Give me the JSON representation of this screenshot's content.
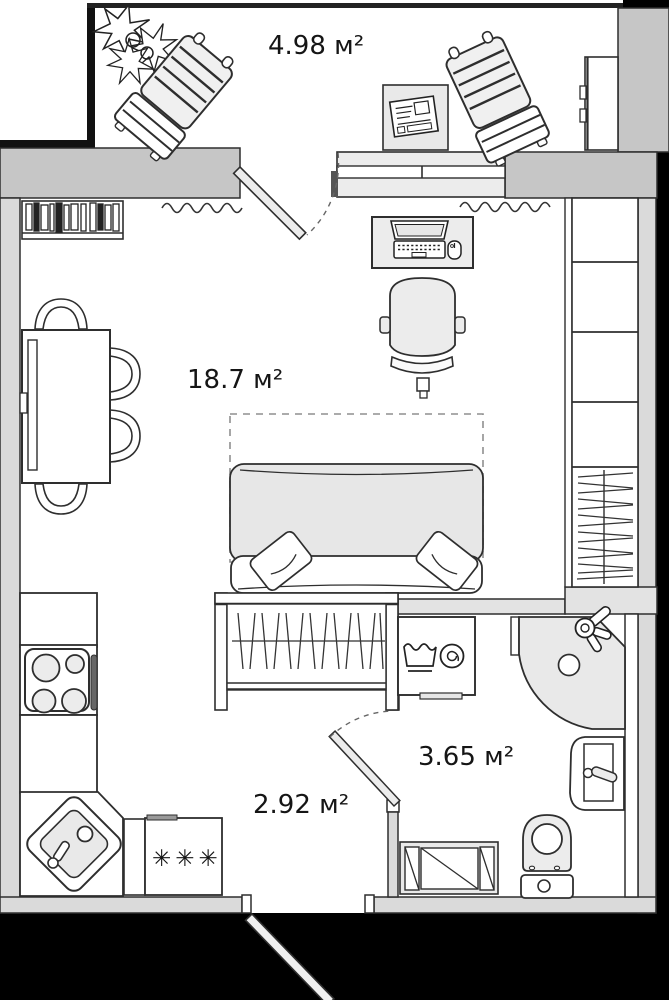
{
  "rooms": {
    "balcony": {
      "area_label": "4.98 м²"
    },
    "living_room": {
      "area_label": "18.7 м²"
    },
    "hallway": {
      "area_label": "2.92 м²"
    },
    "bathroom": {
      "area_label": "3.65 м²"
    }
  },
  "symbols": {
    "fridge_stars": "✳✳✳"
  },
  "colors": {
    "outside": "#000000",
    "wall_mid_gray": "#c6c6c6",
    "wall_light_gray": "#dadada",
    "thin_wall_gray": "#e3e3e3",
    "outline": "#2e2e2e",
    "furniture_fill": "#ececec",
    "floor": "#ffffff"
  }
}
